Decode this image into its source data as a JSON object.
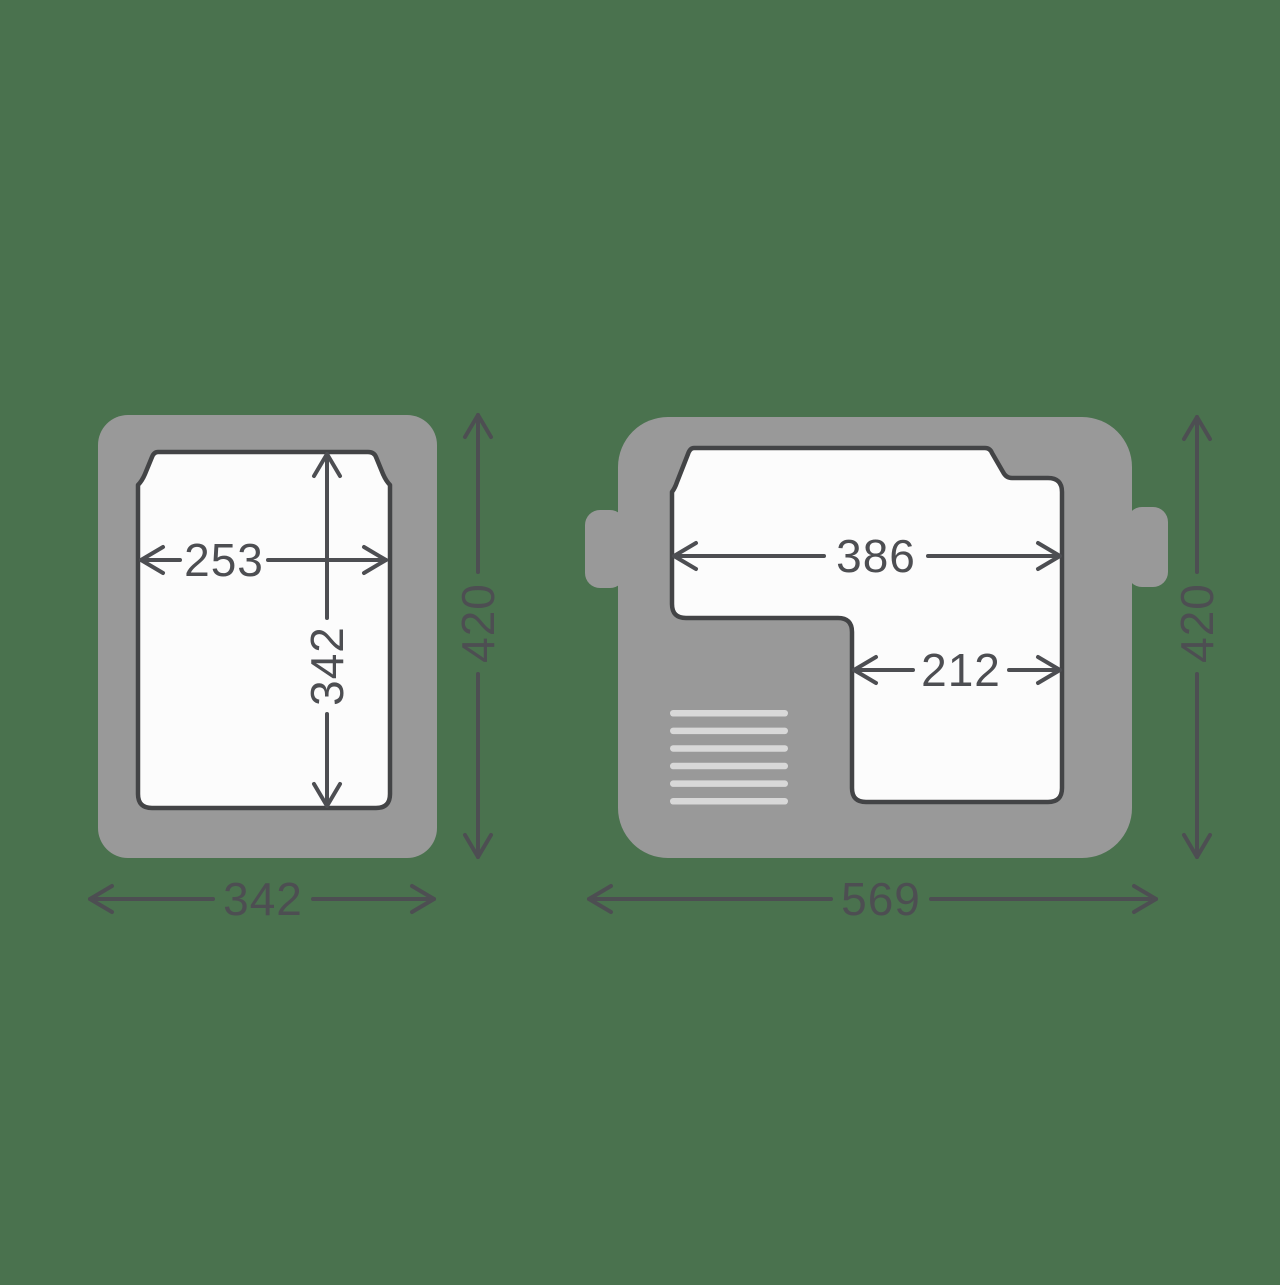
{
  "colors": {
    "background": "#4A724E",
    "body": "#999999",
    "cavity": "#FCFCFC",
    "outline": "#434446",
    "dimension": "#4D4E52",
    "vent": "#D8D8D8"
  },
  "views": [
    {
      "id": "front-view",
      "dimensions": {
        "inner_width": "253",
        "inner_height": "342",
        "outer_height": "420",
        "outer_width": "342"
      }
    },
    {
      "id": "top-view",
      "dimensions": {
        "inner_width": "386",
        "inner_lower_width": "212",
        "outer_height": "420",
        "outer_width": "569"
      }
    }
  ]
}
